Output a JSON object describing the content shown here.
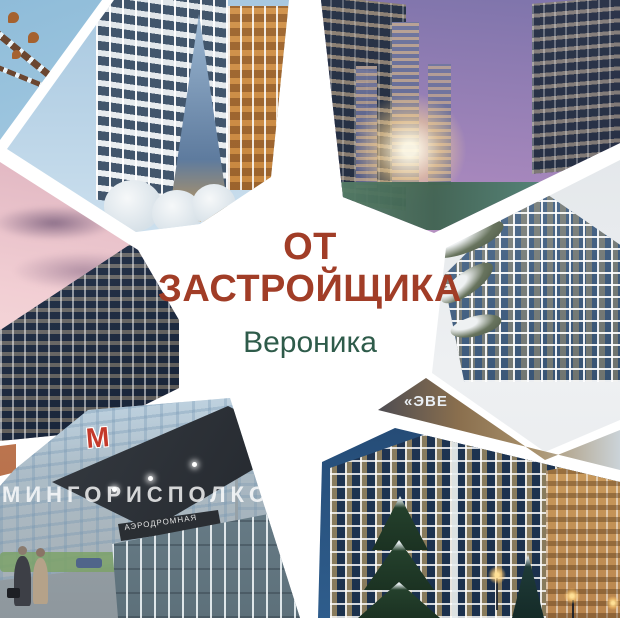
{
  "center_card": {
    "title_line1": "ОТ",
    "title_line2": "ЗАСТРОЙЩИКА",
    "subtitle": "Вероника",
    "title_color": "#A13D27",
    "subtitle_color": "#2E5B4A"
  },
  "photos": {
    "bottom_left_metro": {
      "watermark": "МИНГОРИСПОЛКОМ",
      "station_sign": "АЭРОДРОМНАЯ",
      "metro_logo_letter": "М"
    },
    "right_strip": {
      "watermark_partial": "«ЭВЕ"
    }
  }
}
